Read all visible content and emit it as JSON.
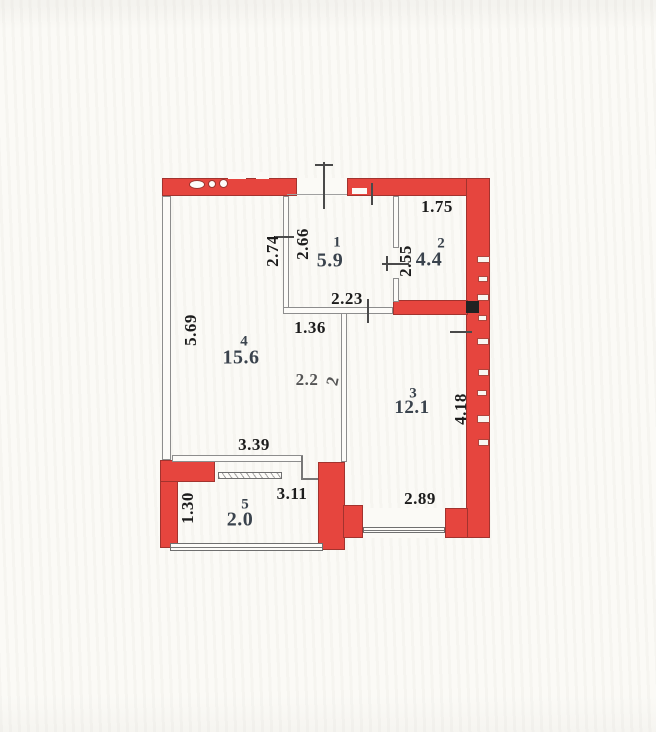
{
  "plan": {
    "type_label": "apartment-floor-plan",
    "rooms": [
      {
        "number": "1",
        "area": "5.9"
      },
      {
        "number": "2",
        "area": "4.4"
      },
      {
        "number": "3",
        "area": "12.1"
      },
      {
        "number": "4",
        "area": "15.6"
      },
      {
        "number": "5",
        "area": "2.0"
      }
    ],
    "dimensions": {
      "room2_width": "1.75",
      "room4_upper_height": "2.74",
      "room1_height": "2.66",
      "room2_height": "2.55",
      "room1_width": "2.23",
      "passage_width": "1.36",
      "room4_height": "5.69",
      "mid_dim": "2.2",
      "mid_dim_rotated_digit": "2",
      "room3_height": "4.18",
      "room4_width": "3.39",
      "balcony_inner_width": "3.11",
      "room3_width": "2.89",
      "balcony_height": "1.30"
    },
    "colors": {
      "wall_fill": "#e6453e",
      "wall_outline": "#a2332e",
      "thin_wall": "#8d8d8d",
      "room_label_text": "#3a434d",
      "dimension_text": "#1c1c1c",
      "paper": "#fbfaf6",
      "shaft_marker": "#222222"
    }
  }
}
